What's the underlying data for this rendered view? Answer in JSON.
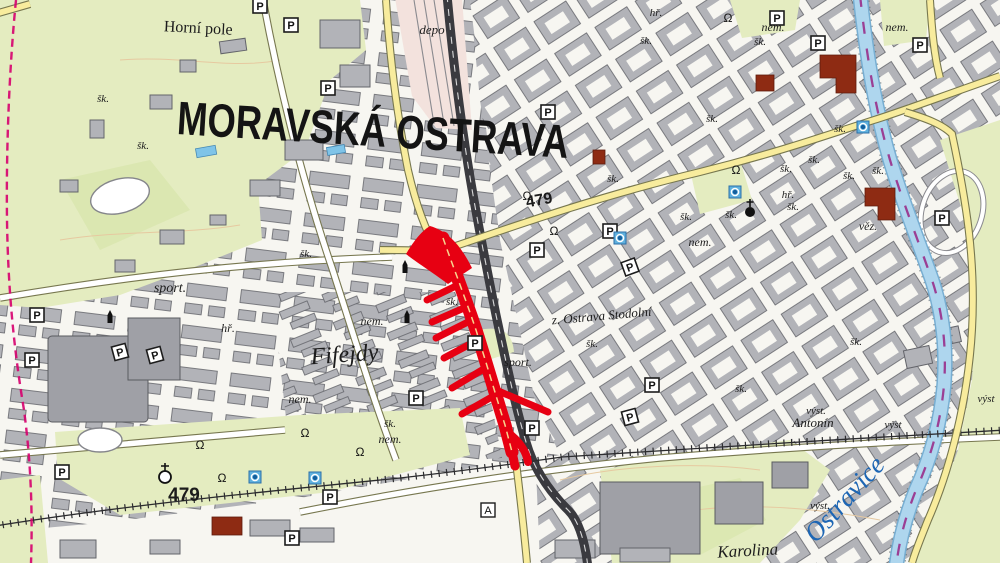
{
  "map": {
    "region_title": "MORAVSKÁ OSTRAVA",
    "colors": {
      "paper": "#f7f6f1",
      "park": "#e4ecc0",
      "parkDark": "#d3e4a4",
      "building": "#b2b3b8",
      "buildingDark": "#63646a",
      "landmark": "#8e2b13",
      "roadYellow": "#f8ec9d",
      "roadCasing": "#77774f",
      "rail": "#3a3a3f",
      "water": "#aed6ee",
      "waterEdge": "#77aed2",
      "waterDash": "#9b3f94",
      "boundary": "#d6006e",
      "route": "#e70012",
      "pool": "#7fc4e8",
      "contour": "#e6c9a0",
      "labelColor": "#1c1c1c",
      "waterLabelColor": "#1d66b4"
    },
    "labels": [
      {
        "t": "MORAVSKÁ OSTRAVA",
        "x": 372,
        "y": 146,
        "s": 47,
        "w": "b",
        "f": "sans",
        "r": 3.5,
        "tl": 392,
        "c": "#141414"
      },
      {
        "t": "Horní pole",
        "x": 198,
        "y": 33,
        "s": 16,
        "r": 3
      },
      {
        "t": "depo",
        "x": 432,
        "y": 34,
        "s": 13,
        "st": "i"
      },
      {
        "t": "479",
        "x": 540,
        "y": 205,
        "s": 16,
        "w": "b",
        "f": "sans",
        "r": -10
      },
      {
        "t": "479",
        "x": 184,
        "y": 501,
        "s": 19,
        "w": "b",
        "f": "sans"
      },
      {
        "t": "sport.",
        "x": 170,
        "y": 292,
        "s": 14,
        "st": "i"
      },
      {
        "t": "sport.",
        "x": 518,
        "y": 366,
        "s": 12,
        "st": "i"
      },
      {
        "t": "hř.",
        "x": 228,
        "y": 332,
        "s": 12,
        "st": "i"
      },
      {
        "t": "hř.",
        "x": 788,
        "y": 198,
        "s": 11,
        "st": "i"
      },
      {
        "t": "hř.",
        "x": 656,
        "y": 16,
        "s": 11,
        "st": "i"
      },
      {
        "t": "Fifejdy",
        "x": 345,
        "y": 362,
        "s": 24,
        "st": "i",
        "r": -4
      },
      {
        "t": "nem.",
        "x": 372,
        "y": 325,
        "s": 12,
        "st": "i"
      },
      {
        "t": "nem.",
        "x": 300,
        "y": 403,
        "s": 12,
        "st": "i"
      },
      {
        "t": "nem.",
        "x": 390,
        "y": 443,
        "s": 12,
        "st": "i"
      },
      {
        "t": "nem.",
        "x": 700,
        "y": 246,
        "s": 12,
        "st": "i"
      },
      {
        "t": "nem.",
        "x": 773,
        "y": 31,
        "s": 12,
        "st": "i"
      },
      {
        "t": "nem.",
        "x": 897,
        "y": 31,
        "s": 12,
        "st": "i"
      },
      {
        "t": "z. Ostrava Stodolní",
        "x": 602,
        "y": 320,
        "s": 13,
        "st": "i",
        "r": -5
      },
      {
        "t": "šk.",
        "x": 592,
        "y": 347,
        "s": 11,
        "st": "i"
      },
      {
        "t": "šk.",
        "x": 103,
        "y": 102,
        "s": 11,
        "st": "i"
      },
      {
        "t": "šk.",
        "x": 143,
        "y": 149,
        "s": 11,
        "st": "i"
      },
      {
        "t": "šk.",
        "x": 306,
        "y": 257,
        "s": 11,
        "st": "i"
      },
      {
        "t": "šk.",
        "x": 452,
        "y": 305,
        "s": 11,
        "st": "i"
      },
      {
        "t": "šk.",
        "x": 390,
        "y": 427,
        "s": 11,
        "st": "i"
      },
      {
        "t": "šk.",
        "x": 613,
        "y": 182,
        "s": 11,
        "st": "i"
      },
      {
        "t": "šk.",
        "x": 686,
        "y": 220,
        "s": 11,
        "st": "i"
      },
      {
        "t": "šk.",
        "x": 731,
        "y": 218,
        "s": 11,
        "st": "i"
      },
      {
        "t": "šk.",
        "x": 646,
        "y": 44,
        "s": 11,
        "st": "i"
      },
      {
        "t": "šk.",
        "x": 760,
        "y": 45,
        "s": 11,
        "st": "i"
      },
      {
        "t": "šk.",
        "x": 712,
        "y": 122,
        "s": 11,
        "st": "i"
      },
      {
        "t": "šk.",
        "x": 786,
        "y": 172,
        "s": 11,
        "st": "i"
      },
      {
        "t": "šk.",
        "x": 814,
        "y": 163,
        "s": 11,
        "st": "i"
      },
      {
        "t": "šk.",
        "x": 849,
        "y": 179,
        "s": 11,
        "st": "i"
      },
      {
        "t": "šk.",
        "x": 878,
        "y": 174,
        "s": 11,
        "st": "i"
      },
      {
        "t": "šk.",
        "x": 793,
        "y": 210,
        "s": 11,
        "st": "i"
      },
      {
        "t": "šk.",
        "x": 856,
        "y": 345,
        "s": 11,
        "st": "i"
      },
      {
        "t": "šk.",
        "x": 741,
        "y": 392,
        "s": 11,
        "st": "i"
      },
      {
        "t": "šk.",
        "x": 840,
        "y": 132,
        "s": 11,
        "st": "i"
      },
      {
        "t": "Karolina",
        "x": 748,
        "y": 556,
        "s": 17,
        "st": "i",
        "r": -3
      },
      {
        "t": "Ostravice",
        "x": 851,
        "y": 505,
        "s": 27,
        "st": "i",
        "c": "#1d66b4",
        "r": -48
      },
      {
        "t": "Antonín",
        "x": 813,
        "y": 427,
        "s": 13,
        "st": "i"
      },
      {
        "t": "výst.",
        "x": 816,
        "y": 414,
        "s": 11,
        "st": "i"
      },
      {
        "t": "výst",
        "x": 893,
        "y": 428,
        "s": 11,
        "st": "i"
      },
      {
        "t": "výst.",
        "x": 820,
        "y": 509,
        "s": 11,
        "st": "i"
      },
      {
        "t": "výst",
        "x": 986,
        "y": 402,
        "s": 11,
        "st": "i"
      },
      {
        "t": "věz.",
        "x": 868,
        "y": 230,
        "s": 12,
        "st": "i"
      }
    ],
    "symbols": [
      {
        "type": "parking",
        "points": [
          [
            260,
            6
          ],
          [
            291,
            25
          ],
          [
            328,
            88
          ],
          [
            548,
            112
          ],
          [
            777,
            18
          ],
          [
            818,
            43
          ],
          [
            920,
            45
          ],
          [
            537,
            250
          ],
          [
            610,
            231
          ],
          [
            630,
            267,
            -20
          ],
          [
            475,
            343
          ],
          [
            416,
            398
          ],
          [
            532,
            428
          ],
          [
            37,
            315
          ],
          [
            32,
            360
          ],
          [
            120,
            352,
            -15
          ],
          [
            155,
            355,
            -15
          ],
          [
            62,
            472
          ],
          [
            330,
            497
          ],
          [
            292,
            538
          ],
          [
            652,
            385
          ],
          [
            630,
            417,
            -15
          ],
          [
            942,
            218
          ]
        ]
      },
      {
        "type": "info",
        "points": [
          [
            735,
            192
          ],
          [
            620,
            238
          ],
          [
            255,
            477
          ],
          [
            315,
            478
          ],
          [
            863,
            127
          ]
        ]
      },
      {
        "type": "bell",
        "points": [
          [
            200,
            445
          ],
          [
            222,
            478
          ],
          [
            360,
            452
          ],
          [
            527,
            196
          ],
          [
            554,
            231
          ],
          [
            736,
            170
          ],
          [
            305,
            433
          ],
          [
            728,
            18
          ]
        ]
      },
      {
        "type": "monument",
        "points": [
          [
            405,
            268
          ],
          [
            407,
            318
          ],
          [
            110,
            318
          ]
        ]
      },
      {
        "type": "church",
        "points": [
          [
            750,
            212
          ]
        ]
      },
      {
        "type": "church-open",
        "points": [
          [
            165,
            477
          ]
        ]
      },
      {
        "type": "box-a",
        "points": [
          [
            488,
            510
          ]
        ]
      }
    ]
  }
}
